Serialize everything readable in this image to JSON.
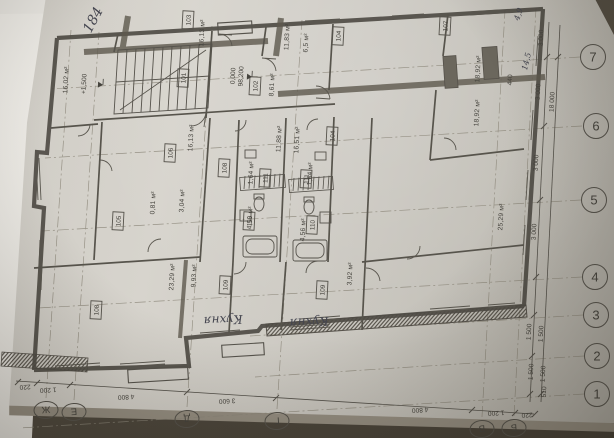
{
  "photo": {
    "description": "photographed architectural floor plan sheet, rotated sideways",
    "paper_color": "#cfccc5",
    "background_color": "#534d42",
    "ink_color": "#4a4841"
  },
  "plan": {
    "room_tags": [
      {
        "label": "103",
        "x": 188,
        "y": 20
      },
      {
        "label": "101",
        "x": 183,
        "y": 78
      },
      {
        "label": "102",
        "x": 255,
        "y": 86
      },
      {
        "label": "104",
        "x": 338,
        "y": 36
      },
      {
        "label": "107",
        "x": 445,
        "y": 26
      },
      {
        "label": "104",
        "x": 332,
        "y": 136
      },
      {
        "label": "106",
        "x": 170,
        "y": 153
      },
      {
        "label": "108",
        "x": 224,
        "y": 168
      },
      {
        "label": "111",
        "x": 265,
        "y": 178
      },
      {
        "label": "111",
        "x": 306,
        "y": 179
      },
      {
        "label": "105",
        "x": 118,
        "y": 221
      },
      {
        "label": "110",
        "x": 249,
        "y": 221
      },
      {
        "label": "110",
        "x": 312,
        "y": 225
      },
      {
        "label": "109",
        "x": 225,
        "y": 285
      },
      {
        "label": "109",
        "x": 322,
        "y": 290
      },
      {
        "label": "108",
        "x": 96,
        "y": 310
      }
    ],
    "area_labels": [
      {
        "text": "16,02 м²",
        "x": 68,
        "y": 80
      },
      {
        "text": "16,13 м²",
        "x": 204,
        "y": 33
      },
      {
        "text": "11,83 м²",
        "x": 289,
        "y": 37
      },
      {
        "text": "6,5 м²",
        "x": 308,
        "y": 43
      },
      {
        "text": "8,61 м²",
        "x": 274,
        "y": 85
      },
      {
        "text": "11,88 м²",
        "x": 281,
        "y": 139
      },
      {
        "text": "16,51 м²",
        "x": 299,
        "y": 140
      },
      {
        "text": "16,13 м²",
        "x": 193,
        "y": 138
      },
      {
        "text": "1,64 м²",
        "x": 253,
        "y": 173
      },
      {
        "text": "1,64 м²",
        "x": 312,
        "y": 174
      },
      {
        "text": "4,56 м²",
        "x": 252,
        "y": 218
      },
      {
        "text": "4,56 м²",
        "x": 305,
        "y": 230
      },
      {
        "text": "3,04 м²",
        "x": 184,
        "y": 201
      },
      {
        "text": "0,81 м²",
        "x": 155,
        "y": 203
      },
      {
        "text": "18,92 м²",
        "x": 480,
        "y": 69
      },
      {
        "text": "18,92 м²",
        "x": 479,
        "y": 113
      },
      {
        "text": "23,29 м²",
        "x": 174,
        "y": 277
      },
      {
        "text": "9,93 м²",
        "x": 196,
        "y": 276
      },
      {
        "text": "25,29 м²",
        "x": 503,
        "y": 217
      },
      {
        "text": "3,92 м²",
        "x": 352,
        "y": 274
      }
    ],
    "elevation_marks": [
      {
        "line1": "0,000",
        "line2": "98,200",
        "x": 235,
        "y": 76
      },
      {
        "line1": "+1,500",
        "line2": "",
        "x": 86,
        "y": 84
      }
    ],
    "handwritten_notes": [
      {
        "text": "184",
        "x": 97,
        "y": 22,
        "rot": -62,
        "size": 14
      },
      {
        "text": "Кухня",
        "x": 223,
        "y": 316,
        "rot": 177,
        "size": 12
      },
      {
        "text": "Кухня",
        "x": 309,
        "y": 318,
        "rot": 177,
        "size": 12
      },
      {
        "text": "4,9",
        "x": 521,
        "y": 15,
        "rot": -72,
        "size": 8
      },
      {
        "text": "14,5",
        "x": 529,
        "y": 62,
        "rot": -76,
        "size": 8
      }
    ],
    "axes": {
      "right_numbers": [
        {
          "label": "7",
          "x": 593,
          "y": 57
        },
        {
          "label": "6",
          "x": 596,
          "y": 126
        },
        {
          "label": "5",
          "x": 594,
          "y": 200
        },
        {
          "label": "4",
          "x": 595,
          "y": 277
        },
        {
          "label": "3",
          "x": 596,
          "y": 315
        },
        {
          "label": "2",
          "x": 597,
          "y": 356
        },
        {
          "label": "1",
          "x": 597,
          "y": 394
        }
      ],
      "bottom_letters": [
        {
          "label": "Ж",
          "x": 46,
          "y": 410
        },
        {
          "label": "Е",
          "x": 74,
          "y": 412
        },
        {
          "label": "Д",
          "x": 187,
          "y": 419
        },
        {
          "label": "Г",
          "x": 277,
          "y": 421
        },
        {
          "label": "В",
          "x": 482,
          "y": 429
        },
        {
          "label": "Б",
          "x": 514,
          "y": 428
        }
      ]
    },
    "dimensions": {
      "right_chain": [
        {
          "text": "3 000",
          "x": 543,
          "y": 38
        },
        {
          "text": "3 000",
          "x": 540,
          "y": 92
        },
        {
          "text": "3 000",
          "x": 538,
          "y": 163
        },
        {
          "text": "3 000",
          "x": 536,
          "y": 232
        },
        {
          "text": "1 500",
          "x": 531,
          "y": 332
        },
        {
          "text": "1 500",
          "x": 543,
          "y": 334
        },
        {
          "text": "1 500",
          "x": 533,
          "y": 372
        },
        {
          "text": "1 500",
          "x": 545,
          "y": 374
        },
        {
          "text": "510",
          "x": 546,
          "y": 392
        },
        {
          "text": "18 000",
          "x": 554,
          "y": 102
        },
        {
          "text": "440",
          "x": 512,
          "y": 80
        }
      ],
      "bottom_chain": [
        {
          "text": "220",
          "x": 25,
          "y": 385
        },
        {
          "text": "1 200",
          "x": 48,
          "y": 388
        },
        {
          "text": "4 800",
          "x": 126,
          "y": 395
        },
        {
          "text": "3 600",
          "x": 227,
          "y": 399
        },
        {
          "text": "4 800",
          "x": 420,
          "y": 408
        },
        {
          "text": "1 200",
          "x": 496,
          "y": 411
        },
        {
          "text": "220",
          "x": 527,
          "y": 413
        }
      ]
    }
  }
}
